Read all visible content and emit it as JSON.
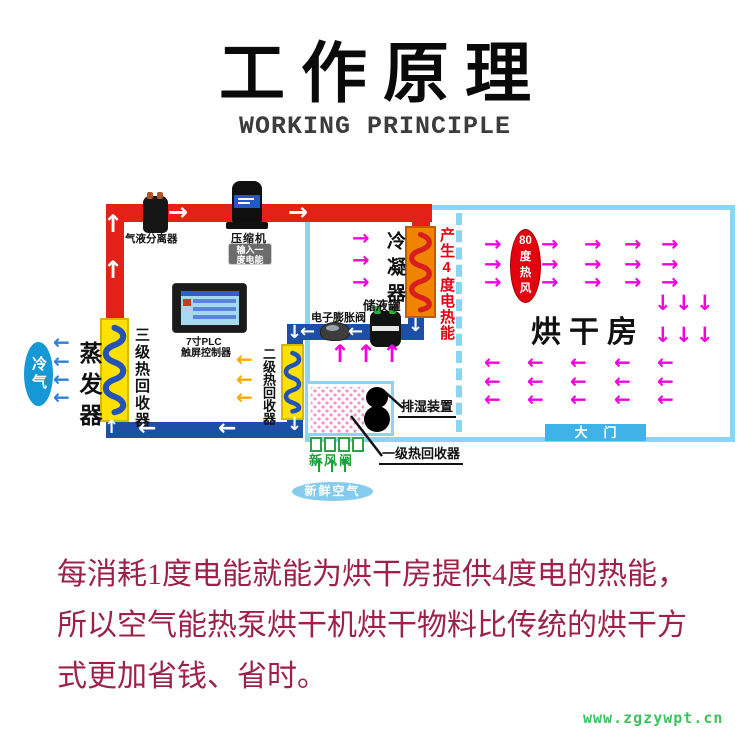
{
  "header": {
    "title": "工作原理",
    "subtitle": "WORKING PRINCIPLE"
  },
  "diagram": {
    "labels": {
      "separator": "气液分离器",
      "compressor": "压缩机",
      "input_badge": [
        "输入一",
        "度电能"
      ],
      "plc": [
        "7寸PLC",
        "触屏控制器"
      ],
      "condenser": "冷凝器",
      "heat_output_note": "产生4度电热能",
      "tank": "储液罐",
      "expansion_valve": "电子膨胀阀",
      "evaporator": "蒸发器",
      "cold_air": "冷气",
      "stage3_recovery": "三级热回收器",
      "stage2_recovery": "二级热回收器",
      "stage1_recovery": "一级热回收器",
      "dehumidifier": "排湿装置",
      "fresh_air_valve": "新风阀",
      "fresh_air": "新鲜空气",
      "drying_room": "烘干房",
      "door": "大门",
      "hot_air": [
        "80",
        "度",
        "热",
        "风"
      ]
    },
    "colors": {
      "hot_pipe_red": "#E32119",
      "liquid_pipe_blue": "#1D4FA6",
      "room_border_blue": "#8DD4F2",
      "airflow_magenta": "#F400E0",
      "recovery_yellow": "#FFE100",
      "condenser_orange": "#F08300",
      "hot_air_badge_red": "#E3000F",
      "fresh_air_green": "#12A038",
      "cold_air_blue": "#1798D6",
      "caption_red": "#9D2247",
      "watermark_green": "#3DC45E"
    },
    "flow_arrows": [
      {
        "name": "machine-airflow-right",
        "glyph": "→",
        "color": "#F400E0",
        "size": 21,
        "xs": [
          352
        ],
        "ys": [
          228,
          250,
          272
        ]
      },
      {
        "name": "room-airflow-right",
        "glyph": "→",
        "color": "#F400E0",
        "size": 21,
        "xs": [
          484,
          541,
          584,
          624,
          661
        ],
        "ys": [
          234,
          254,
          272
        ]
      },
      {
        "name": "room-airflow-down",
        "glyph": "↓",
        "color": "#F400E0",
        "size": 21,
        "xs": [
          654,
          675,
          696
        ],
        "ys": [
          293,
          325
        ]
      },
      {
        "name": "room-airflow-left",
        "glyph": "←",
        "color": "#F400E0",
        "size": 20,
        "xs": [
          484,
          527,
          570,
          614,
          657
        ],
        "ys": [
          352,
          371,
          389
        ]
      },
      {
        "name": "machine-airflow-up",
        "glyph": "↑",
        "color": "#F400E0",
        "size": 24,
        "xs": [
          330,
          356,
          382
        ],
        "ys": [
          342
        ]
      },
      {
        "name": "stage2-exhaust-left",
        "glyph": "←",
        "color": "#FFAA00",
        "size": 20,
        "xs": [
          236
        ],
        "ys": [
          349,
          369,
          387
        ]
      },
      {
        "name": "cold-air-left",
        "glyph": "←",
        "color": "#2F80D6",
        "size": 20,
        "xs": [
          53
        ],
        "ys": [
          332,
          351,
          369,
          387
        ]
      },
      {
        "name": "fresh-air-up",
        "glyph": "↑",
        "color": "#12A038",
        "size": 17,
        "xs": [
          312,
          325,
          338
        ],
        "ys": [
          459
        ]
      },
      {
        "name": "hot-pipe-flow-right",
        "glyph": "→",
        "color": "#FFFFFF",
        "size": 24,
        "xs": [
          168,
          288
        ],
        "ys": [
          200
        ]
      },
      {
        "name": "hot-pipe-flow-up",
        "glyph": "↑",
        "color": "#FFFFFF",
        "size": 24,
        "xs": [
          103
        ],
        "ys": [
          212,
          258
        ]
      },
      {
        "name": "liquid-pipe-flow-left",
        "glyph": "←",
        "color": "#FFFFFF",
        "size": 22,
        "xs": [
          138,
          218
        ],
        "ys": [
          418
        ]
      },
      {
        "name": "tank-line-flow-left",
        "glyph": "←",
        "color": "#FFFFFF",
        "size": 18,
        "xs": [
          300,
          348
        ],
        "ys": [
          323
        ]
      },
      {
        "name": "condenser-out-down",
        "glyph": "↓",
        "color": "#FFFFFF",
        "size": 18,
        "xs": [
          408
        ],
        "ys": [
          317
        ]
      },
      {
        "name": "tank-line-corner-down",
        "glyph": "↓",
        "color": "#FFFFFF",
        "size": 18,
        "xs": [
          287
        ],
        "ys": [
          324
        ]
      },
      {
        "name": "stage2-out-down",
        "glyph": "↓",
        "color": "#FFFFFF",
        "size": 18,
        "xs": [
          287
        ],
        "ys": [
          416
        ]
      },
      {
        "name": "stage3-in-up",
        "glyph": "↑",
        "color": "#FFFFFF",
        "size": 18,
        "xs": [
          104
        ],
        "ys": [
          419
        ]
      }
    ]
  },
  "caption": {
    "lines": [
      "每消耗1度电能就能为烘干房提供4度电的热能，",
      "所以空气能热泵烘干机烘干物料比传统的烘干方",
      "式更加省钱、省时。"
    ]
  },
  "watermark": {
    "text": "www.zgzywpt.cn"
  }
}
